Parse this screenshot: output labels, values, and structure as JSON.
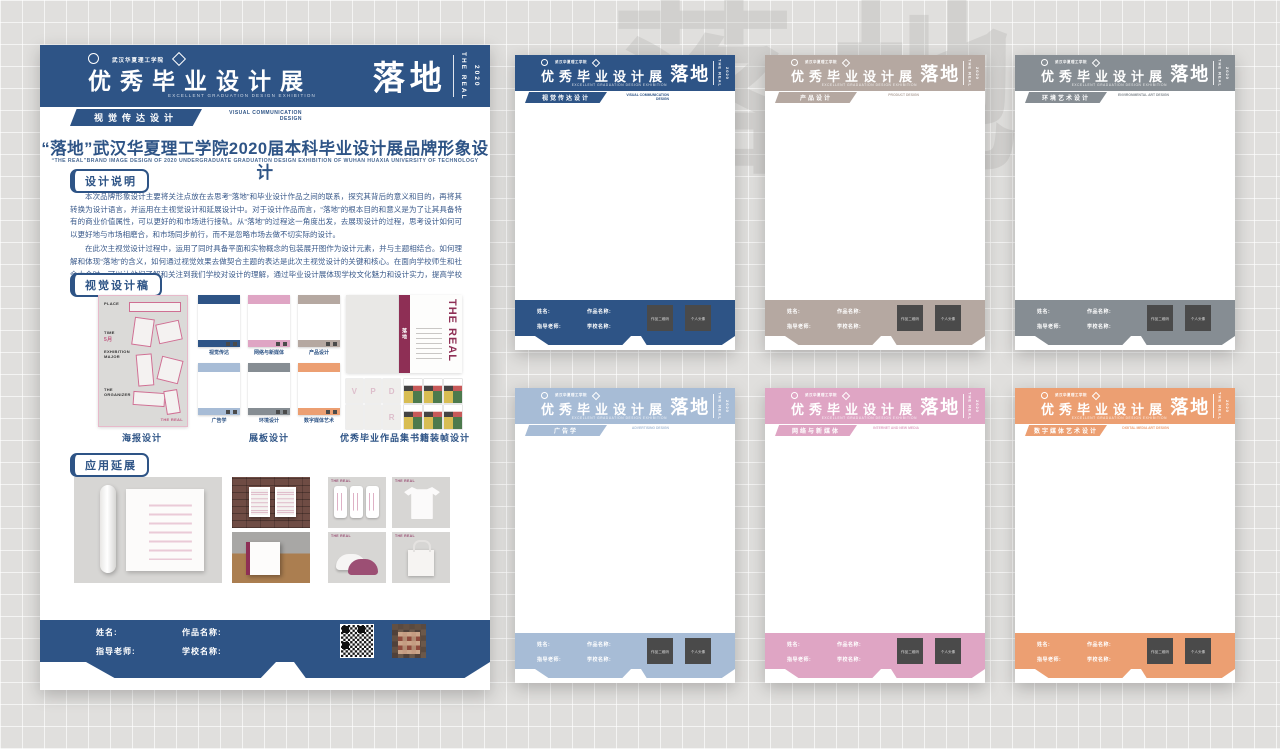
{
  "background": {
    "watermark": "落地"
  },
  "colors": {
    "primary_blue": "#2e5486",
    "taupe": "#b5a8a1",
    "gray": "#868d93",
    "light_blue": "#a7bcd6",
    "pink": "#dfa5c4",
    "orange": "#ec9f72",
    "maroon": "#8e2f55"
  },
  "main_poster": {
    "header": {
      "school_name": "武汉华夏理工学院",
      "title": "优秀毕业设计展",
      "subtitle_en": "EXCELLENT GRADUATION DESIGN EXHIBITION",
      "brand": "落地",
      "brand_en": "THE REAL",
      "brand_year": "2020"
    },
    "tab": {
      "zh": "视觉传达设计",
      "en": "VISUAL COMMUNICATION DESIGN"
    },
    "title_zh": "“落地”武汉华夏理工学院2020届本科毕业设计展品牌形象设计",
    "title_en": "“THE REAL”BRAND IMAGE DESIGN OF 2020 UNDERGRADUATE GRADUATION DESIGN EXHIBITION OF WUHAN HUAXIA UNIVERSITY OF TECHNOLOGY",
    "design_notes": {
      "badge": "设计说明",
      "paragraphs": [
        "本次品牌形象设计主要将关注点放在去思考“落地”和毕业设计作品之间的联系，探究其背后的意义和目的，再将其转换为设计语言，并运用在主视觉设计和延展设计中。对于设计作品而言，“落地”的根本目的和意义是为了让其具备特有的商业价值属性，可以更好的和市场进行接轨。从“落地”的过程这一角度出发，去展现设计的过程，思考设计如何可以更好地与市场相磨合，和市场同步前行，而不是忽略市场去做不切实际的设计。",
        "在此次主视觉设计过程中，运用了同时具备平面和实物概念的包装展开图作为设计元素，并与主题相结合。如何理解和体现“落地”的含义，如何通过视觉效果去做契合主题的表达是此次主视觉设计的关键和核心。在面向学校师生和社会大众时，可以让他们了解和关注到我们学校对设计的理解，通过毕业设计展体现学校文化魅力和设计实力，提高学校的品牌影响力。"
      ]
    },
    "visual_drafts": {
      "badge": "视觉设计稿",
      "poster_label": "海报设计",
      "boards_label": "展板设计",
      "book_label": "优秀毕业作品集书籍装帧设计",
      "poster_thumb": {
        "place": "PLACE",
        "time": "TIME",
        "month": "5月",
        "major": "EXHIBITION MAJOR",
        "organizer": "THE ORGANIZER",
        "brand": "THE REAL"
      },
      "boards": [
        {
          "label": "视觉传达",
          "color": "#2e5486"
        },
        {
          "label": "网络与新媒体",
          "color": "#dfa5c4"
        },
        {
          "label": "产品设计",
          "color": "#b5a8a1"
        },
        {
          "label": "广告学",
          "color": "#a7bcd6"
        },
        {
          "label": "环境设计",
          "color": "#868d93"
        },
        {
          "label": "数字媒体艺术",
          "color": "#ec9f72"
        }
      ],
      "book": {
        "title_en": "THE REAL",
        "spine": "落地",
        "page_letters": [
          "V",
          "P",
          "D",
          "",
          "",
          "R"
        ]
      }
    },
    "applications": {
      "badge": "应用延展",
      "item_caption": "THE REAL"
    },
    "footer": {
      "name_label": "姓名:",
      "work_label": "作品名称:",
      "advisor_label": "指导老师:",
      "school_label": "学校名称:"
    }
  },
  "template_shared": {
    "header_title": "优秀毕业设计展",
    "header_subtitle_en": "EXCELLENT GRADUATION DESIGN EXHIBITION",
    "brand": "落地",
    "brand_en": "THE REAL",
    "brand_year": "2020",
    "footer": {
      "name_label": "姓名:",
      "work_label": "作品名称:",
      "advisor_label": "指导老师:",
      "school_label": "学校名称:"
    },
    "qr_box_label": "作品二维码",
    "avatar_box_label": "个人头像"
  },
  "templates": [
    {
      "category_zh": "视觉传达设计",
      "category_en": "VISUAL COMMUNICATION DESIGN",
      "color": "#2e5486"
    },
    {
      "category_zh": "产品设计",
      "category_en": "PRODUCT DESIGN",
      "color": "#b5a8a1"
    },
    {
      "category_zh": "环境艺术设计",
      "category_en": "ENVIRONMENTAL ART DESIGN",
      "color": "#868d93"
    },
    {
      "category_zh": "广告学",
      "category_en": "ADVERTISING DESIGN",
      "color": "#a7bcd6"
    },
    {
      "category_zh": "网络与新媒体",
      "category_en": "INTERNET AND NEW MEDIA",
      "color": "#dfa5c4"
    },
    {
      "category_zh": "数字媒体艺术设计",
      "category_en": "DIGITAL MEDIA ART DESIGN",
      "color": "#ec9f72"
    }
  ]
}
